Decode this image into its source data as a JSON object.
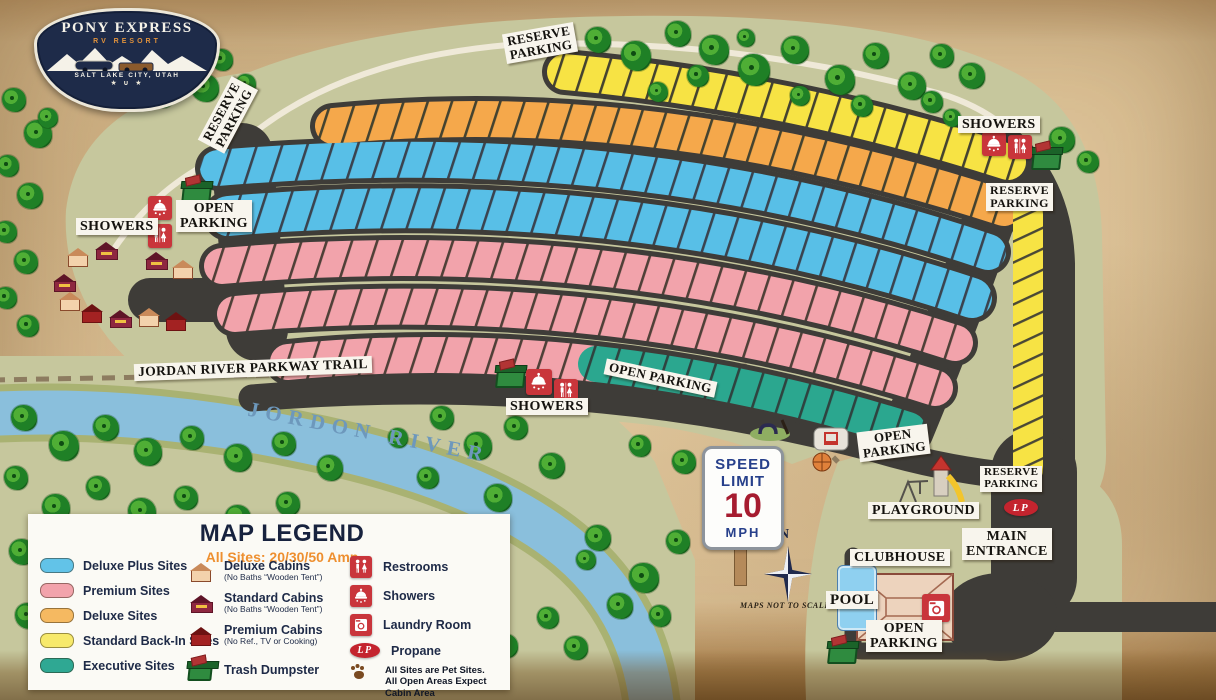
{
  "logo": {
    "title": "PONY EXPRESS",
    "subtitle": "RV RESORT",
    "location": "SALT LAKE CITY, UTAH",
    "stars": "★ ∪ ★"
  },
  "map": {
    "labels": {
      "reserve_top": "RESERVE\nPARKING",
      "reserve_west": "RESERVE\nPARKING",
      "showers_ne": "SHOWERS",
      "reserve_ne": "RESERVE\nPARKING",
      "showers_w": "SHOWERS",
      "open_w": "OPEN\nPARKING",
      "trail": "JORDAN RIVER PARKWAY TRAIL",
      "showers_c": "SHOWERS",
      "open_c": "OPEN PARKING",
      "open_e": "OPEN\nPARKING",
      "playground": "PLAYGROUND",
      "reserve_se": "RESERVE\nPARKING",
      "main_entrance": "MAIN\nENTRANCE",
      "clubhouse": "CLUBHOUSE",
      "pool": "POOL",
      "open_s": "OPEN\nPARKING"
    },
    "river_name": "JORDON RIVER",
    "scale_note": "MAPS NOT TO SCALE",
    "compass_north": "N",
    "propane_badge": "LP",
    "speed_sign": {
      "line1": "SPEED",
      "line2": "LIMIT",
      "value": "10",
      "unit": "MPH"
    }
  },
  "legend": {
    "title": "MAP LEGEND",
    "subtitle": "All Sites: 20/30/50 Amp",
    "site_types": [
      {
        "label": "Deluxe Plus Sites",
        "color": "#62c3e8"
      },
      {
        "label": "Premium Sites",
        "color": "#f2a3ab"
      },
      {
        "label": "Deluxe Sites",
        "color": "#f5b961"
      },
      {
        "label": "Standard Back-In Sites",
        "color": "#f7e96b"
      },
      {
        "label": "Executive Sites",
        "color": "#2fa893"
      }
    ],
    "cabins": [
      {
        "label": "Deluxe Cabins",
        "note": "(No Baths “Wooden Tent”)"
      },
      {
        "label": "Standard Cabins",
        "note": "(No Baths “Wooden Tent”)"
      },
      {
        "label": "Premium Cabins",
        "note": "(No Ref., TV or Cooking)"
      }
    ],
    "trash_label": "Trash Dumpster",
    "facilities": [
      {
        "label": "Restrooms"
      },
      {
        "label": "Showers"
      },
      {
        "label": "Laundry Room"
      },
      {
        "label": "Propane"
      }
    ],
    "pet_note": "All Sites are Pet Sites.\nAll Open Areas Expect Cabin Area"
  },
  "colors": {
    "road": "#3e3c38",
    "ground": "#c6c79d",
    "river": "#8abfdc",
    "site_blue": "#58bfe7",
    "site_pink": "#f2a3ab",
    "site_orange": "#f5a84b",
    "site_yellow": "#f7e344",
    "site_teal": "#2ba78f",
    "icon_red": "#c9353b",
    "navy": "#1e2b49",
    "accent_orange": "#ee8f2f"
  }
}
